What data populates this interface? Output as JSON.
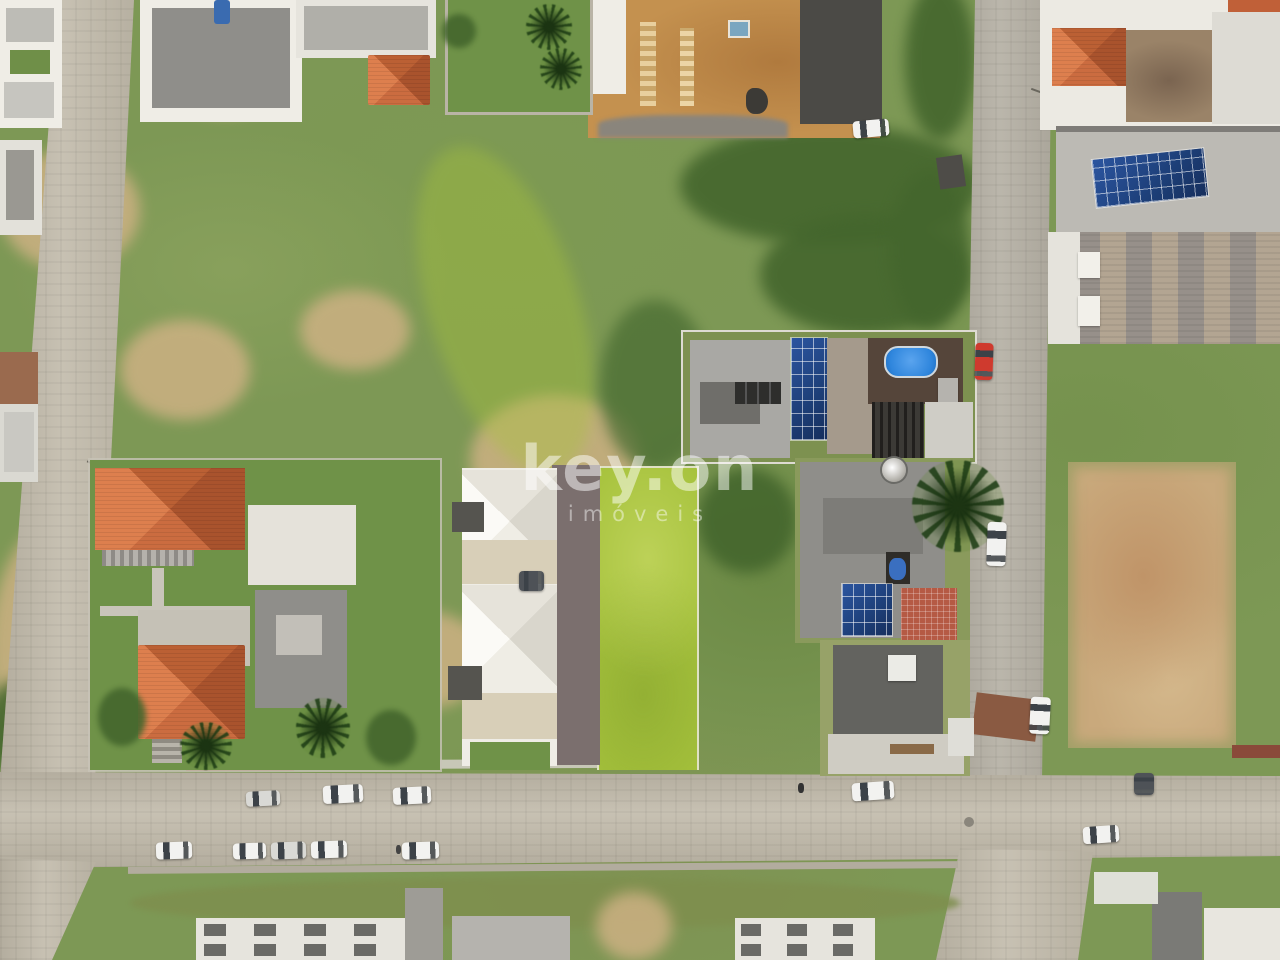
{
  "image_type": "aerial-drone-photograph",
  "scene_description": "overhead drone view of a residential neighborhood block with vacant lots, houses with solar panels, a rooftop pool, paver streets and parked cars",
  "watermark": {
    "brand": "key.on",
    "subtitle": "imóveis"
  },
  "palette": {
    "grass": "#7d9855",
    "grass_dark": "#44662d",
    "grass_bright": "#a6c23c",
    "grass_olive": "#7e8f4e",
    "sand": "#cdb183",
    "street": "#c1baaa",
    "street_gray": "#b3aea2",
    "dirt_lot": "#c9a97c",
    "construction_dirt": "#c4914f",
    "roof_orange": "#c4693e",
    "roof_white": "#efede6",
    "roof_gray": "#8f8e8a",
    "roof_dark": "#63635f",
    "warehouse_dark": "#4b4a46",
    "solar_blue": "#1d3f78",
    "pool_blue": "#2f86dd",
    "deck_brown": "#55453a",
    "brick_red": "#b55a44",
    "rust_roof": "#8a5a42",
    "car_red": "#cf3a2e",
    "car_white": "#f2f2f0",
    "car_silver": "#d9d9d5",
    "car_dark": "#4e5257"
  },
  "cars": [
    {
      "x": 246,
      "y": 791,
      "w": 34,
      "h": 15,
      "angle": -3,
      "color": "car_silver"
    },
    {
      "x": 323,
      "y": 785,
      "w": 40,
      "h": 18,
      "angle": -3,
      "color": "car_white"
    },
    {
      "x": 393,
      "y": 787,
      "w": 38,
      "h": 17,
      "angle": -3,
      "color": "car_white"
    },
    {
      "x": 852,
      "y": 782,
      "w": 42,
      "h": 18,
      "angle": -4,
      "color": "car_white"
    },
    {
      "x": 1134,
      "y": 773,
      "w": 20,
      "h": 22,
      "angle": 0,
      "color": "car_dark"
    },
    {
      "x": 1083,
      "y": 826,
      "w": 36,
      "h": 17,
      "angle": -4,
      "color": "car_white"
    },
    {
      "x": 156,
      "y": 842,
      "w": 36,
      "h": 17,
      "angle": -2,
      "color": "car_white"
    },
    {
      "x": 233,
      "y": 843,
      "w": 33,
      "h": 16,
      "angle": -2,
      "color": "car_white"
    },
    {
      "x": 271,
      "y": 842,
      "w": 35,
      "h": 17,
      "angle": -2,
      "color": "car_silver"
    },
    {
      "x": 311,
      "y": 841,
      "w": 36,
      "h": 17,
      "angle": -2,
      "color": "car_white"
    },
    {
      "x": 402,
      "y": 842,
      "w": 37,
      "h": 17,
      "angle": -2,
      "color": "car_white"
    },
    {
      "x": 853,
      "y": 120,
      "w": 36,
      "h": 17,
      "angle": -5,
      "color": "car_white"
    },
    {
      "x": 975,
      "y": 343,
      "w": 18,
      "h": 37,
      "angle": 2,
      "color": "car_red"
    },
    {
      "x": 987,
      "y": 522,
      "w": 19,
      "h": 44,
      "angle": 2,
      "color": "car_white"
    },
    {
      "x": 1030,
      "y": 697,
      "w": 20,
      "h": 37,
      "angle": 3,
      "color": "car_white"
    },
    {
      "x": 519,
      "y": 571,
      "w": 25,
      "h": 20,
      "angle": 0,
      "color": "car_dark"
    }
  ]
}
